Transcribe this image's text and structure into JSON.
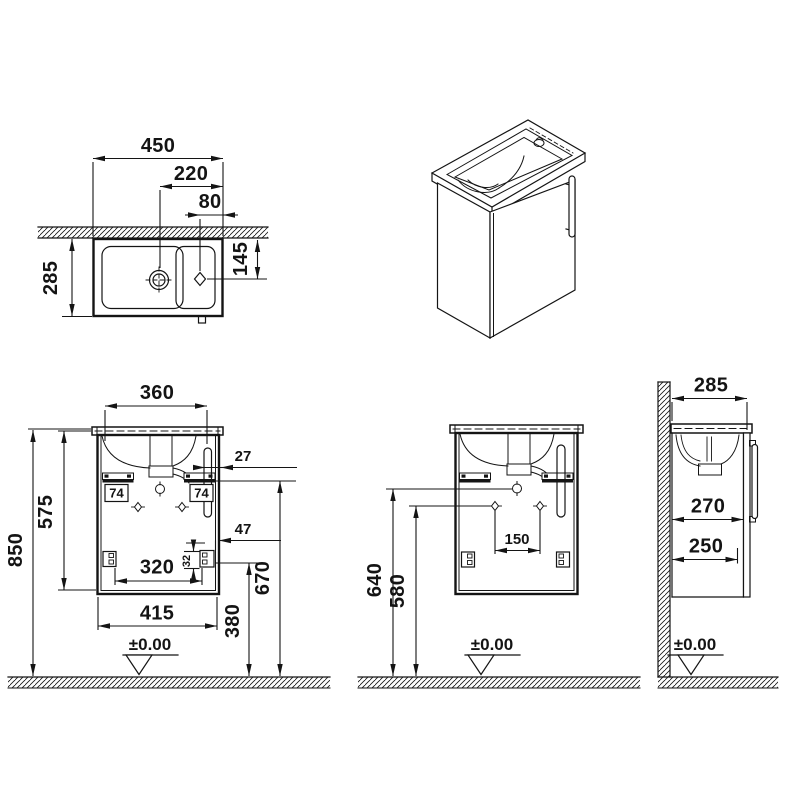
{
  "style": {
    "ink_color": "#141414",
    "background_color": "#ffffff"
  },
  "views": {
    "top_view": {
      "name": "top view",
      "overall_width_mm": "450",
      "drain_to_edge_mm": "220",
      "tap_to_edge_mm": "80",
      "depth_mm": "285",
      "tap_from_wall_mm": "145"
    },
    "front_view": {
      "name": "front view",
      "basin_width_mm": "360",
      "overall_height_mm": "850",
      "cabinet_height_mm": "575",
      "handle_edge_gap_mm": "27",
      "left_bracket_mm": "74",
      "right_bracket_mm": "74",
      "corner_bracket_offset_mm": "47",
      "corner_bracket_height_mm": "32",
      "fixing_span_mm": "320",
      "cabinet_width_mm": "415",
      "lower_fixing_height_mm": "380",
      "upper_fixing_height_mm": "670",
      "floor_level": "±0.00"
    },
    "rear_view": {
      "name": "rear view",
      "hole_spacing_mm": "150",
      "upper_hole_height_mm": "640",
      "lower_hole_height_mm": "580",
      "floor_level": "±0.00"
    },
    "side_view": {
      "name": "side view",
      "overall_depth_mm": "285",
      "depth_with_door_mm": "270",
      "body_depth_mm": "250",
      "floor_level": "±0.00"
    }
  }
}
